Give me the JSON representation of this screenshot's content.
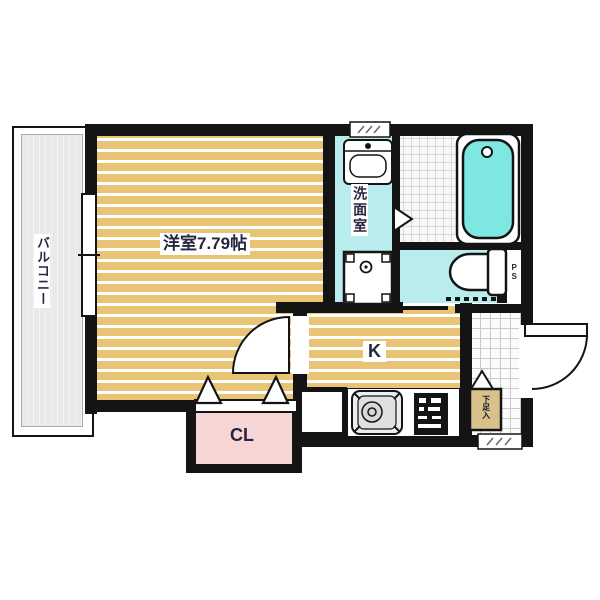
{
  "floorplan": {
    "rooms": {
      "balcony": {
        "label": "バルコニー"
      },
      "main_room": {
        "label": "洋室7.79帖"
      },
      "washroom": {
        "label": "洗面室"
      },
      "kitchen": {
        "label": "K"
      },
      "closet": {
        "label": "CL"
      },
      "pipe_space": {
        "label": "PS"
      },
      "shoe_box": {
        "label": "下足入"
      }
    },
    "colors": {
      "wall": "#141414",
      "floor_tan": "#e9c474",
      "wet_area_cyan": "#b9eded",
      "bathtub_cyan": "#7fe7e2",
      "closet_pink": "#f8d6d6",
      "balcony_gray": "#e9e9e9",
      "shoe_box_tan": "#d9c18c",
      "label_text": "#26263f"
    }
  }
}
